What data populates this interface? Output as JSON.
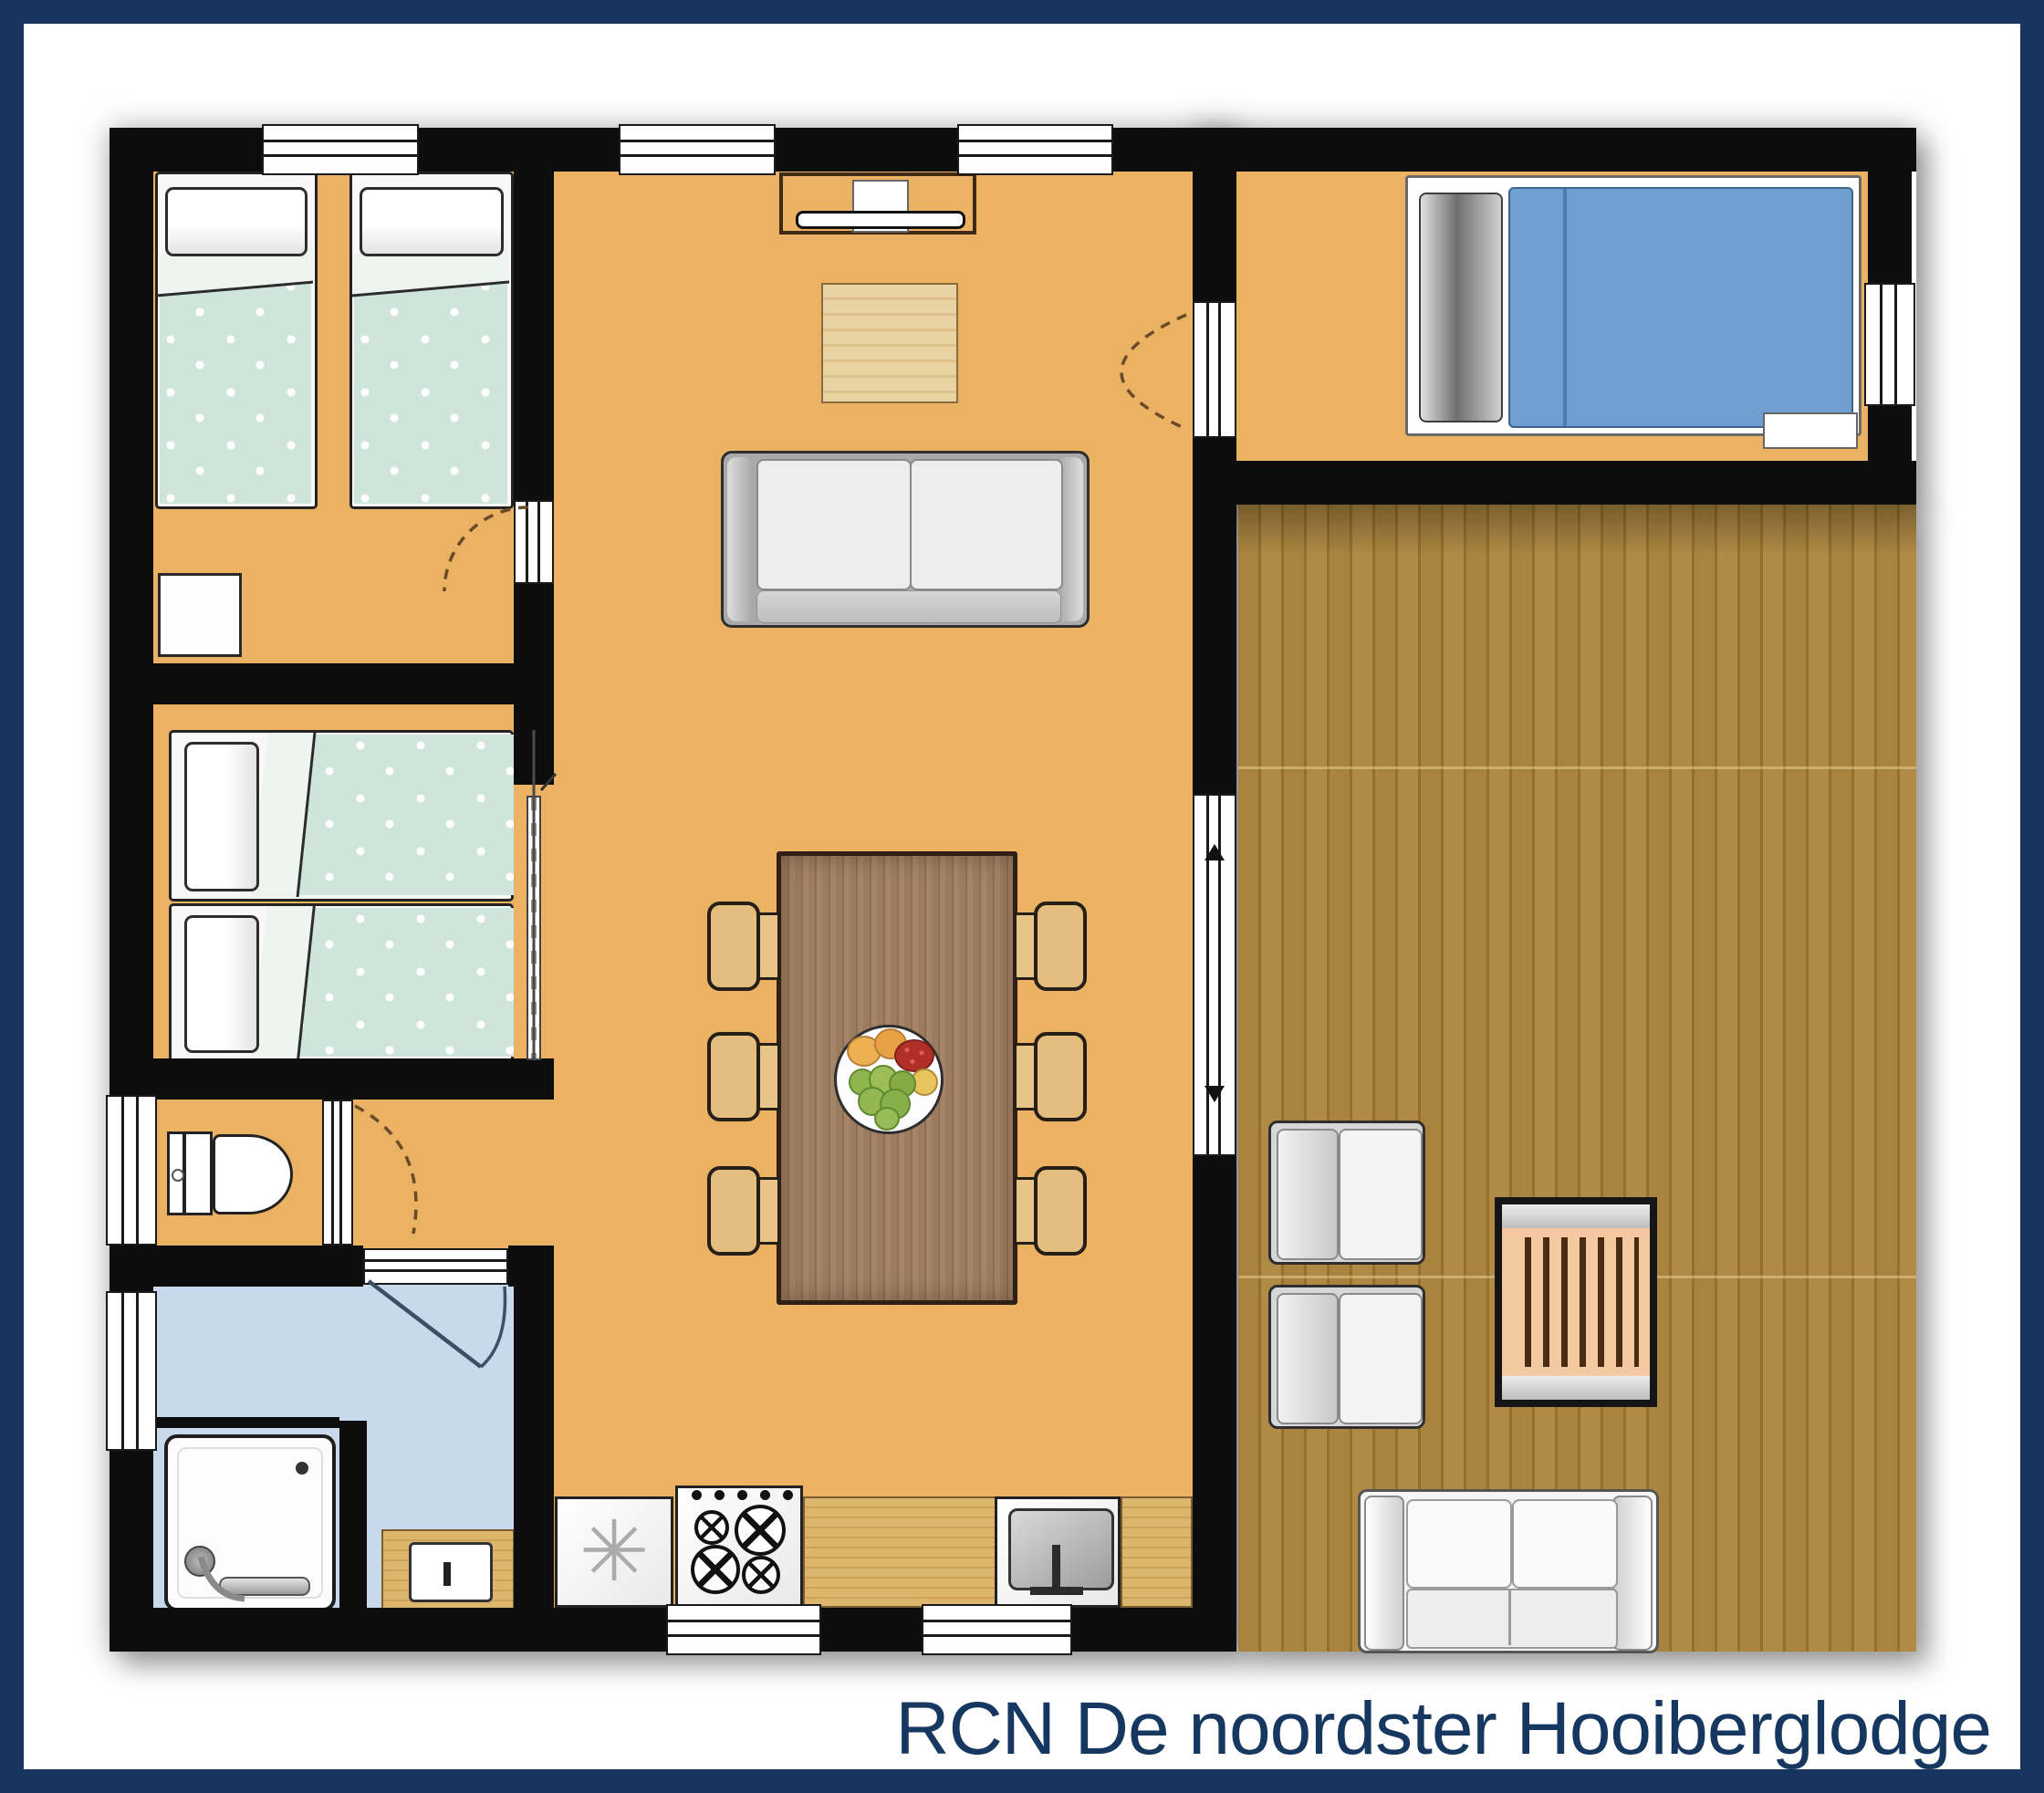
{
  "title": "RCN De noordster Hooiberglodge",
  "icons": {
    "freezer_symbol": "✳"
  },
  "colors": {
    "frame": "#17355e",
    "title_text": "#16375f",
    "wall": "#0d0d0d",
    "floor": "#eab262",
    "bath_floor": "#c8d9eb",
    "duvet_teal": "#cfe5dc",
    "duvet_blue": "#6f9fd0",
    "slat_table_top": "#f4c9a1"
  }
}
